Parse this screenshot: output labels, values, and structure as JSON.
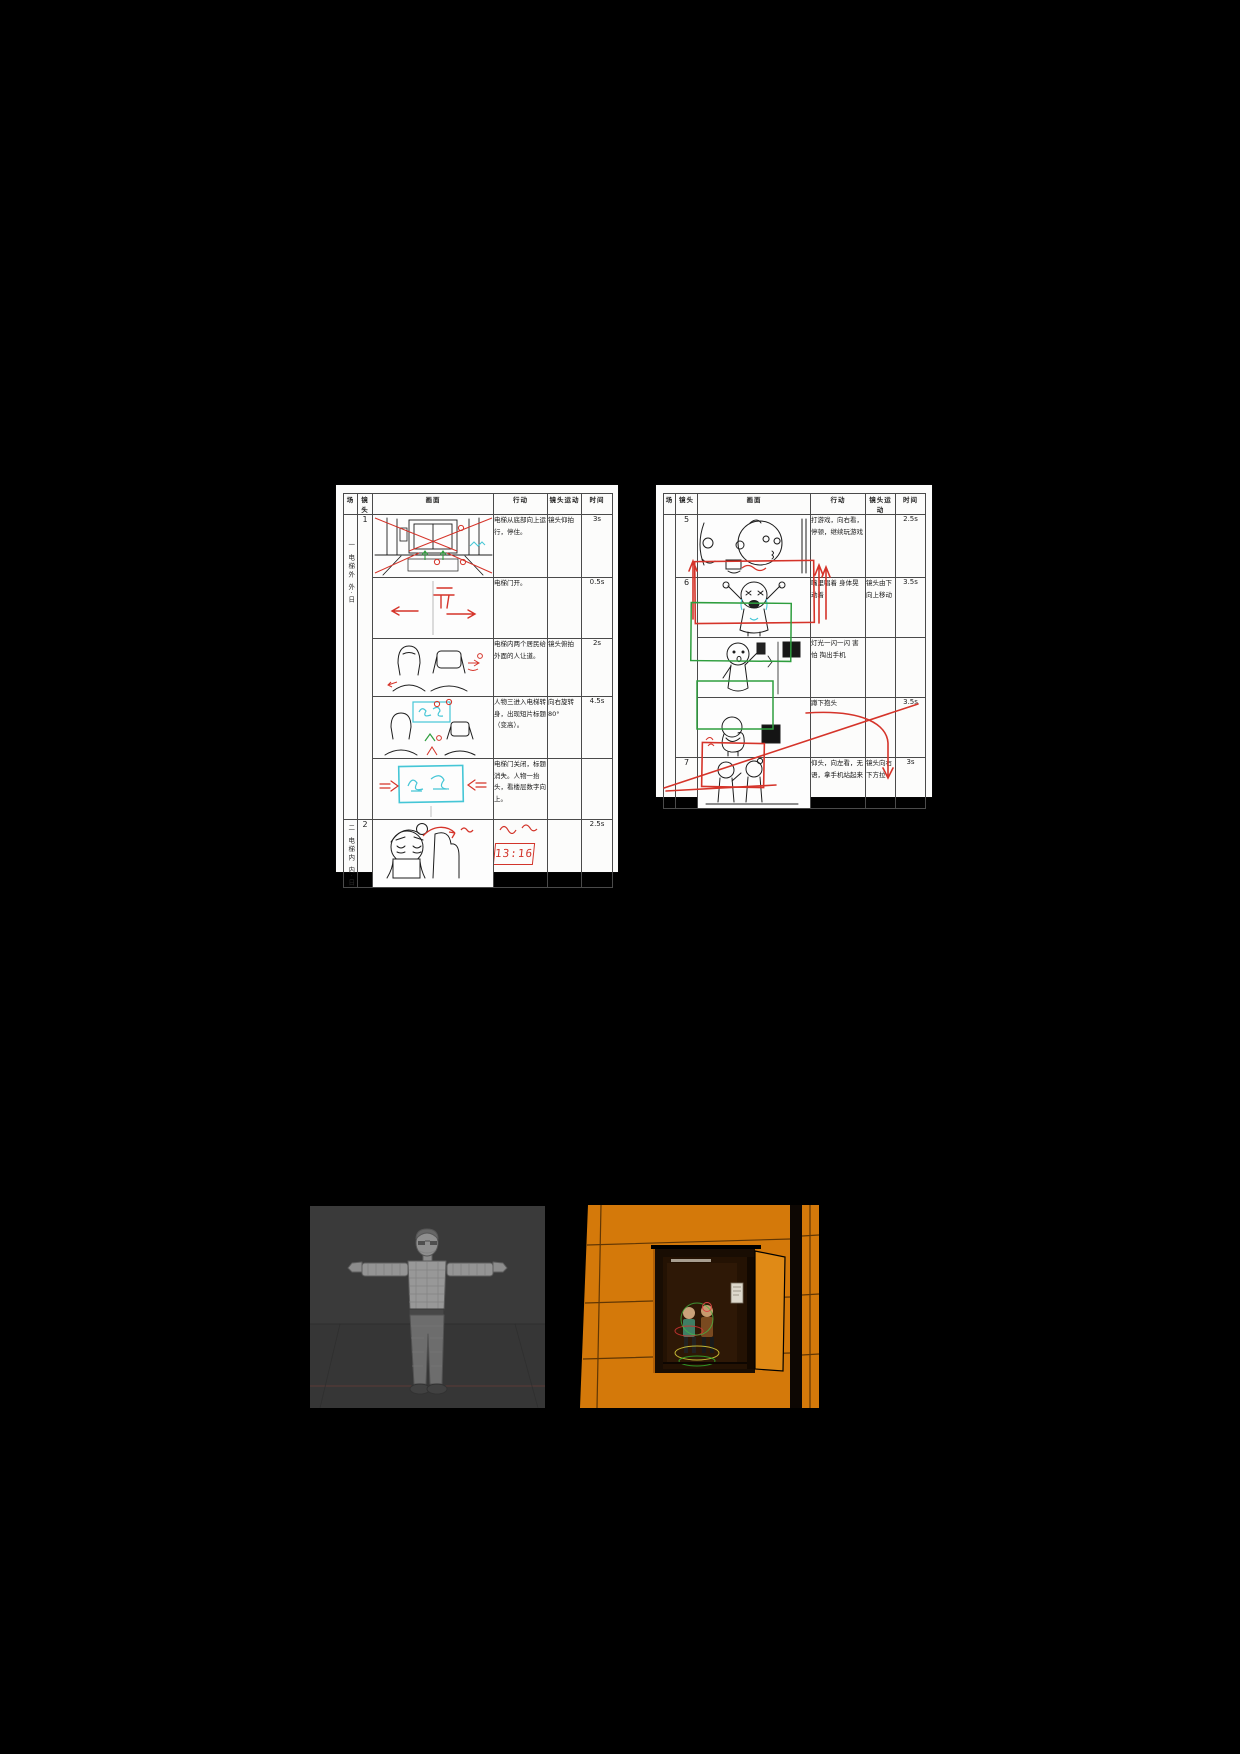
{
  "page": {
    "background": "#000000",
    "paper_color": "#fcfcfb"
  },
  "headers": {
    "scene": "场",
    "shot": "镜头",
    "picture": "画面",
    "action": "行动",
    "camera_move": "镜头运动",
    "time": "时间"
  },
  "storyboard_left": {
    "scene1_label": "一 电梯外 外·日",
    "scene2_label": "二 电梯内 内·日",
    "rows": [
      {
        "shot": "1",
        "sketch": "elevator-exterior-perspective-red-guides",
        "action": "电梯从底部向上运行，停住。",
        "camera_move": "镜头仰拍",
        "time": "3s"
      },
      {
        "shot": "",
        "sketch": "elevator-door-opening-red-arrows",
        "sketch_label": "开",
        "action": "电梯门开。",
        "camera_move": "",
        "time": "0.5s"
      },
      {
        "shot": "",
        "sketch": "two-residents-from-behind",
        "action": "电梯内两个居民给外面的人让道。",
        "camera_move": "镜头俯拍",
        "time": "2s"
      },
      {
        "shot": "",
        "sketch": "title-appearing-cyan-box",
        "sketch_label": "标题",
        "action": "人物三进入电梯转身，出现短片标题（变高）。",
        "camera_move": "向右旋转 80°",
        "time": "4.5s"
      },
      {
        "shot": "",
        "sketch": "title-card-cyan-box-red-arrows",
        "sketch_label": "标题",
        "action": "电梯门关闭，标题消失。人物一抬头，看楼层数字向上。",
        "camera_move": "",
        "time": ""
      },
      {
        "shot": "2",
        "sketch": "tired-woman-face-red-arrow",
        "action": "",
        "red_display": "13:16",
        "camera_move": "",
        "time": "2.5s"
      }
    ]
  },
  "storyboard_right": {
    "rows": [
      {
        "shot": "5",
        "sketch": "two-faces-playing-game",
        "action": "打游戏，向右看，停顿，继续玩游戏",
        "action_style": "red-handwriting",
        "camera_move": "",
        "time": "2.5s"
      },
      {
        "shot": "6",
        "sketch": "crying-singing-figure-red-green-frames",
        "action": "嘴里唱着 身体晃动着",
        "camera_move": "镜头由下向上移动",
        "time": "3.5s"
      },
      {
        "shot": "",
        "sketch": "figure-scared-with-phone",
        "action": "灯光一闪一闪 害怕 掏出手机",
        "camera_move": "",
        "time": ""
      },
      {
        "shot": "",
        "sketch": "figure-squatting-covering-head",
        "action": "蹲下抱头",
        "camera_move": "",
        "time": "3.5s"
      },
      {
        "shot": "7",
        "sketch": "two-figures-standing-red-guides",
        "action": "仰头，向左看，无语，拿手机站起来",
        "camera_move": "镜头向右下方拉",
        "time": "3s"
      }
    ]
  },
  "images": {
    "model_viewport": {
      "description": "3D wireframe character model in T-pose on gray viewport"
    },
    "render_viewport": {
      "description": "orange 3D building wall with open elevator and two rigged characters"
    }
  }
}
